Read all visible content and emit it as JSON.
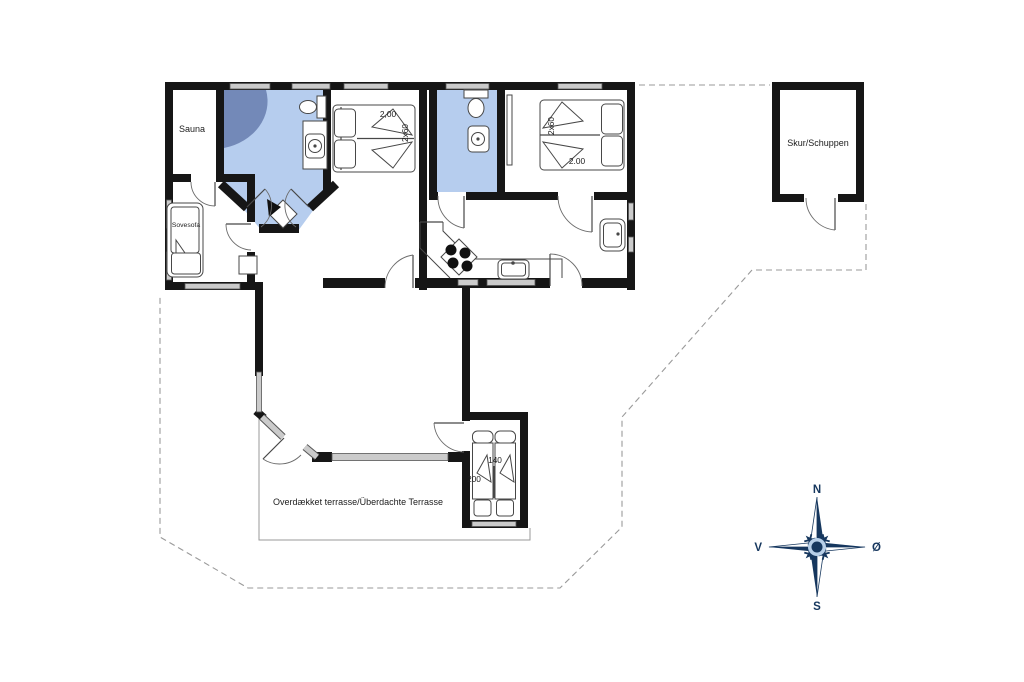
{
  "labels": {
    "sauna": "Sauna",
    "sovesofa": "Sovesofa",
    "shed": "Skur/Schuppen",
    "terrace": "Overdækket terrasse/Überdachte Terrasse"
  },
  "dimensions": {
    "bedroom1_length": "2,00",
    "bedroom1_bed": "2x60",
    "bedroom2_bed": "2x60",
    "bedroom2_length": "2.00",
    "bedroom3_bed_width": "140",
    "bedroom3_bed_length": "200"
  },
  "compass": {
    "north": "N",
    "east": "Ø",
    "south": "S",
    "west": "V"
  },
  "colors": {
    "wet_room_floor": "#b6cdee",
    "shower": "#7389b8",
    "compass_navy": "#16375e",
    "compass_light": "#b7cfe8"
  }
}
